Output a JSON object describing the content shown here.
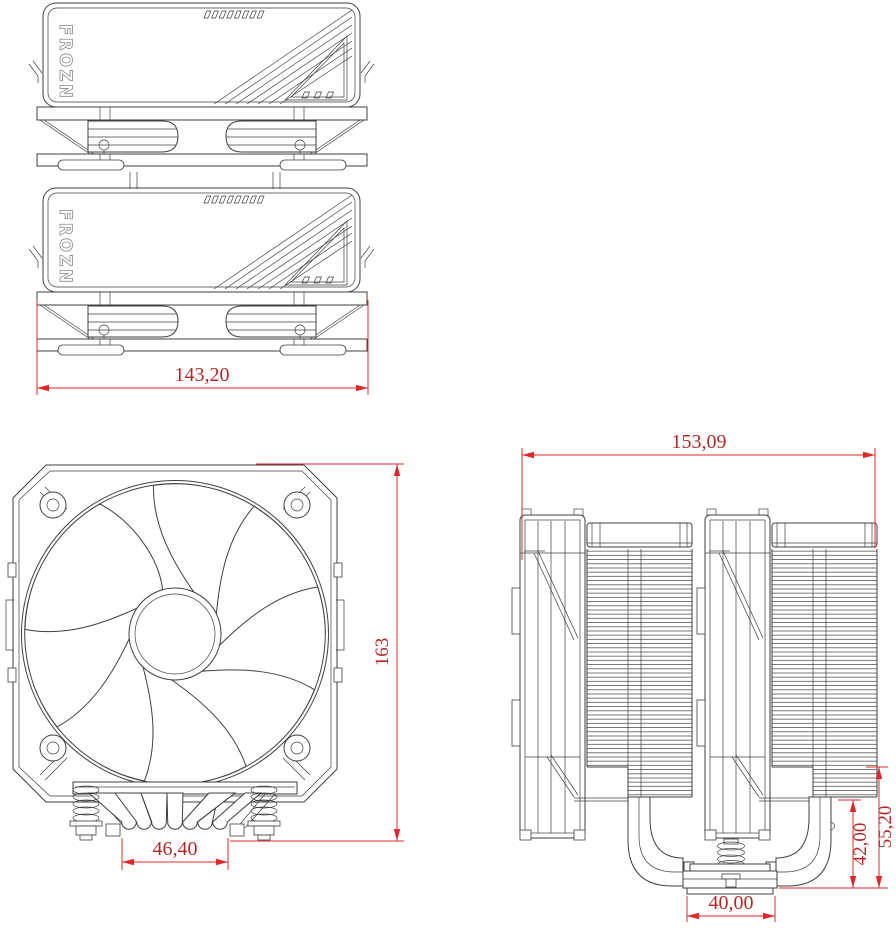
{
  "brand": "FROZN",
  "dimensions": {
    "top_width": "143,20",
    "front_height": "163",
    "front_pipe_base_width": "46,40",
    "side_width": "153,09",
    "side_ram_clearance": "42,00",
    "side_fin_clearance": "55,20",
    "side_base_width": "40,00"
  },
  "colors": {
    "line": "#3f3f3f",
    "dimension_line": "#e02828",
    "dimension_text": "#b52828",
    "background": "#ffffff"
  }
}
